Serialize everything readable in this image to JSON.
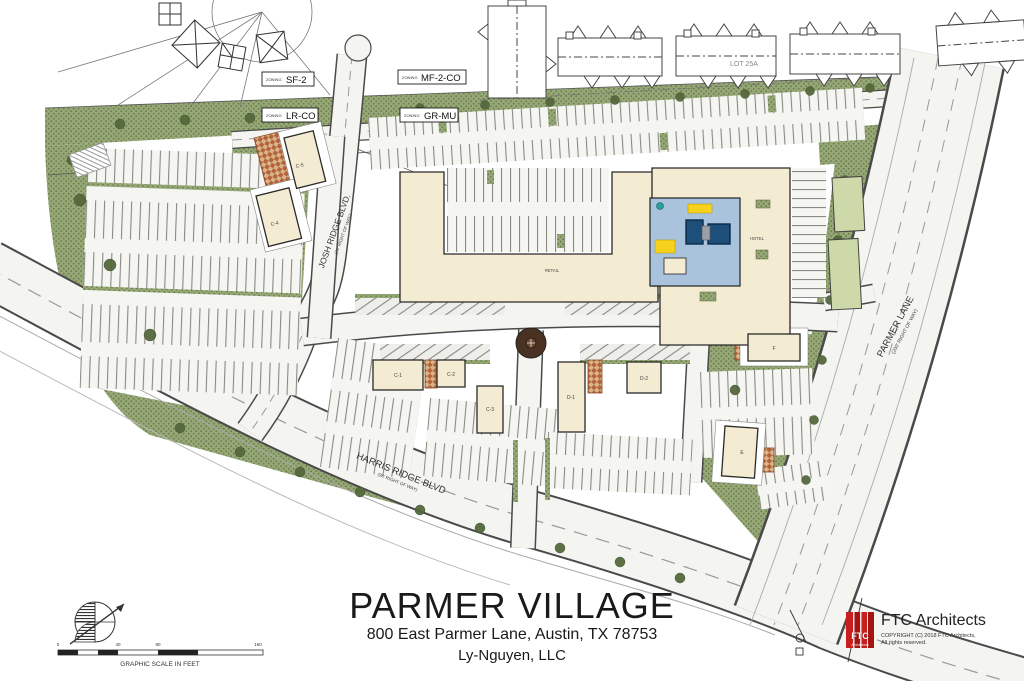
{
  "title_block": {
    "project": "PARMER VILLAGE",
    "address": "800 East Parmer Lane, Austin, TX 78753",
    "owner": "Ly-Nguyen, LLC"
  },
  "architect": {
    "name": "FTC Architects",
    "logo_acronym": "FTC",
    "logo_word": "Architects",
    "copyright1": "COPYRIGHT (C) 2018 FTC Architects,",
    "copyright2": "All rights reserved."
  },
  "graphic_scale": {
    "label": "GRAPHIC SCALE IN FEET",
    "ticks": [
      "0",
      "40",
      "80",
      "160"
    ]
  },
  "zoning": {
    "prefix": "ZONING",
    "sf2": "SF-2",
    "mf2co": "MF-2-CO",
    "lrco": "LR-CO",
    "grmu": "GR-MU"
  },
  "roads": {
    "josh": {
      "name": "JOSH RIDGE BLVD.",
      "row": "(74' RIGHT OF WAY)"
    },
    "harris": {
      "name": "HARRIS RIDGE BLVD",
      "row": "(96' RIGHT OF WAY)"
    },
    "parmer": {
      "name": "PARMER LANE",
      "row": "(200' RIGHT OF WAY)"
    }
  },
  "lots": {
    "lot25a": "LOT 25A"
  },
  "buildings": {
    "c1": "C-1",
    "c2": "C-2",
    "c3": "C-3",
    "c4": "C-4",
    "c5": "C-5",
    "d1": "D-1",
    "d2": "D-2",
    "e": "E",
    "f": "F",
    "hotel": "HOTEL",
    "retail": "RETAIL"
  },
  "colors": {
    "landscape": "#97a877",
    "landscape_dark": "#6b7d4e",
    "building": "#f3ecd2",
    "pool_deck": "#a9c3dc",
    "pool_water": "#1e4f7a",
    "plaza": "#b4633a",
    "roundabout": "#4a3222",
    "road": "#f4f4f1",
    "highlight": "#f7d21c",
    "logo_red": "#c81e1e"
  }
}
